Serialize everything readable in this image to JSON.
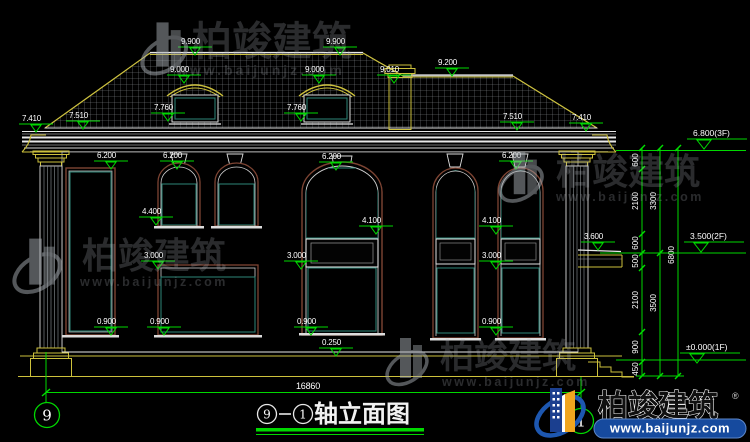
{
  "drawing": {
    "elevation_marks": [
      {
        "t": "9.900",
        "x": 181,
        "y": 44
      },
      {
        "t": "9.900",
        "x": 326,
        "y": 44
      },
      {
        "t": "9.000",
        "x": 170,
        "y": 72
      },
      {
        "t": "9.000",
        "x": 305,
        "y": 72
      },
      {
        "t": "9.010",
        "x": 380,
        "y": 72
      },
      {
        "t": "9.200",
        "x": 438,
        "y": 65
      },
      {
        "t": "7.760",
        "x": 154,
        "y": 110
      },
      {
        "t": "7.760",
        "x": 287,
        "y": 110
      },
      {
        "t": "7.510",
        "x": 69,
        "y": 118
      },
      {
        "t": "7.510",
        "x": 503,
        "y": 119
      },
      {
        "t": "7.410",
        "x": 22,
        "y": 121
      },
      {
        "t": "7.410",
        "x": 572,
        "y": 120
      },
      {
        "t": "6.200",
        "x": 97,
        "y": 158
      },
      {
        "t": "6.200",
        "x": 163,
        "y": 158
      },
      {
        "t": "6.200",
        "x": 322,
        "y": 159
      },
      {
        "t": "6.200",
        "x": 502,
        "y": 158
      },
      {
        "t": "4.400",
        "x": 142,
        "y": 214
      },
      {
        "t": "4.100",
        "x": 362,
        "y": 223
      },
      {
        "t": "4.100",
        "x": 482,
        "y": 223
      },
      {
        "t": "3.600",
        "x": 584,
        "y": 239
      },
      {
        "t": "3.000",
        "x": 144,
        "y": 258
      },
      {
        "t": "3.000",
        "x": 287,
        "y": 258
      },
      {
        "t": "3.000",
        "x": 482,
        "y": 258
      },
      {
        "t": "0.900",
        "x": 97,
        "y": 324
      },
      {
        "t": "0.900",
        "x": 150,
        "y": 324
      },
      {
        "t": "0.900",
        "x": 297,
        "y": 324
      },
      {
        "t": "0.900",
        "x": 482,
        "y": 324
      },
      {
        "t": "0.250",
        "x": 322,
        "y": 345
      }
    ],
    "level_marks": [
      {
        "t": "6.800(3F)",
        "x": 693,
        "y": 136
      },
      {
        "t": "3.500(2F)",
        "x": 690,
        "y": 239
      },
      {
        "t": "±0.000(1F)",
        "x": 686,
        "y": 350
      }
    ],
    "vchain_labels": [
      {
        "t": "600",
        "x": 642,
        "y": 160
      },
      {
        "t": "2100",
        "x": 642,
        "y": 201
      },
      {
        "t": "600",
        "x": 642,
        "y": 243
      },
      {
        "t": "500",
        "x": 642,
        "y": 261
      },
      {
        "t": "2100",
        "x": 642,
        "y": 300
      },
      {
        "t": "900",
        "x": 642,
        "y": 347
      },
      {
        "t": "450",
        "x": 642,
        "y": 369
      },
      {
        "t": "3300",
        "x": 660,
        "y": 201
      },
      {
        "t": "3500",
        "x": 660,
        "y": 303
      },
      {
        "t": "6800",
        "x": 678,
        "y": 255
      }
    ],
    "vchains": [
      {
        "x": 642,
        "ys": [
          148,
          169,
          234,
          253,
          268,
          332,
          362,
          376
        ]
      },
      {
        "x": 660,
        "ys": [
          148,
          253,
          376
        ]
      },
      {
        "x": 678,
        "ys": [
          148,
          376
        ]
      }
    ],
    "total_width": "16860",
    "axis_bubbles": {
      "left": "9",
      "right": "1"
    },
    "title": {
      "axis_a": "9",
      "sep": "-",
      "axis_b": "1",
      "text": "轴立面图"
    },
    "accent_green": "#00d800",
    "cad_yellow": "#cdc13c",
    "cad_teal": "#2e8678"
  },
  "watermark": {
    "brand": "柏竣建筑",
    "url": "www.baijunjz.com"
  },
  "logo": {
    "brand": "柏竣建筑",
    "url": "www.baijunjz.com",
    "reg": "®"
  }
}
